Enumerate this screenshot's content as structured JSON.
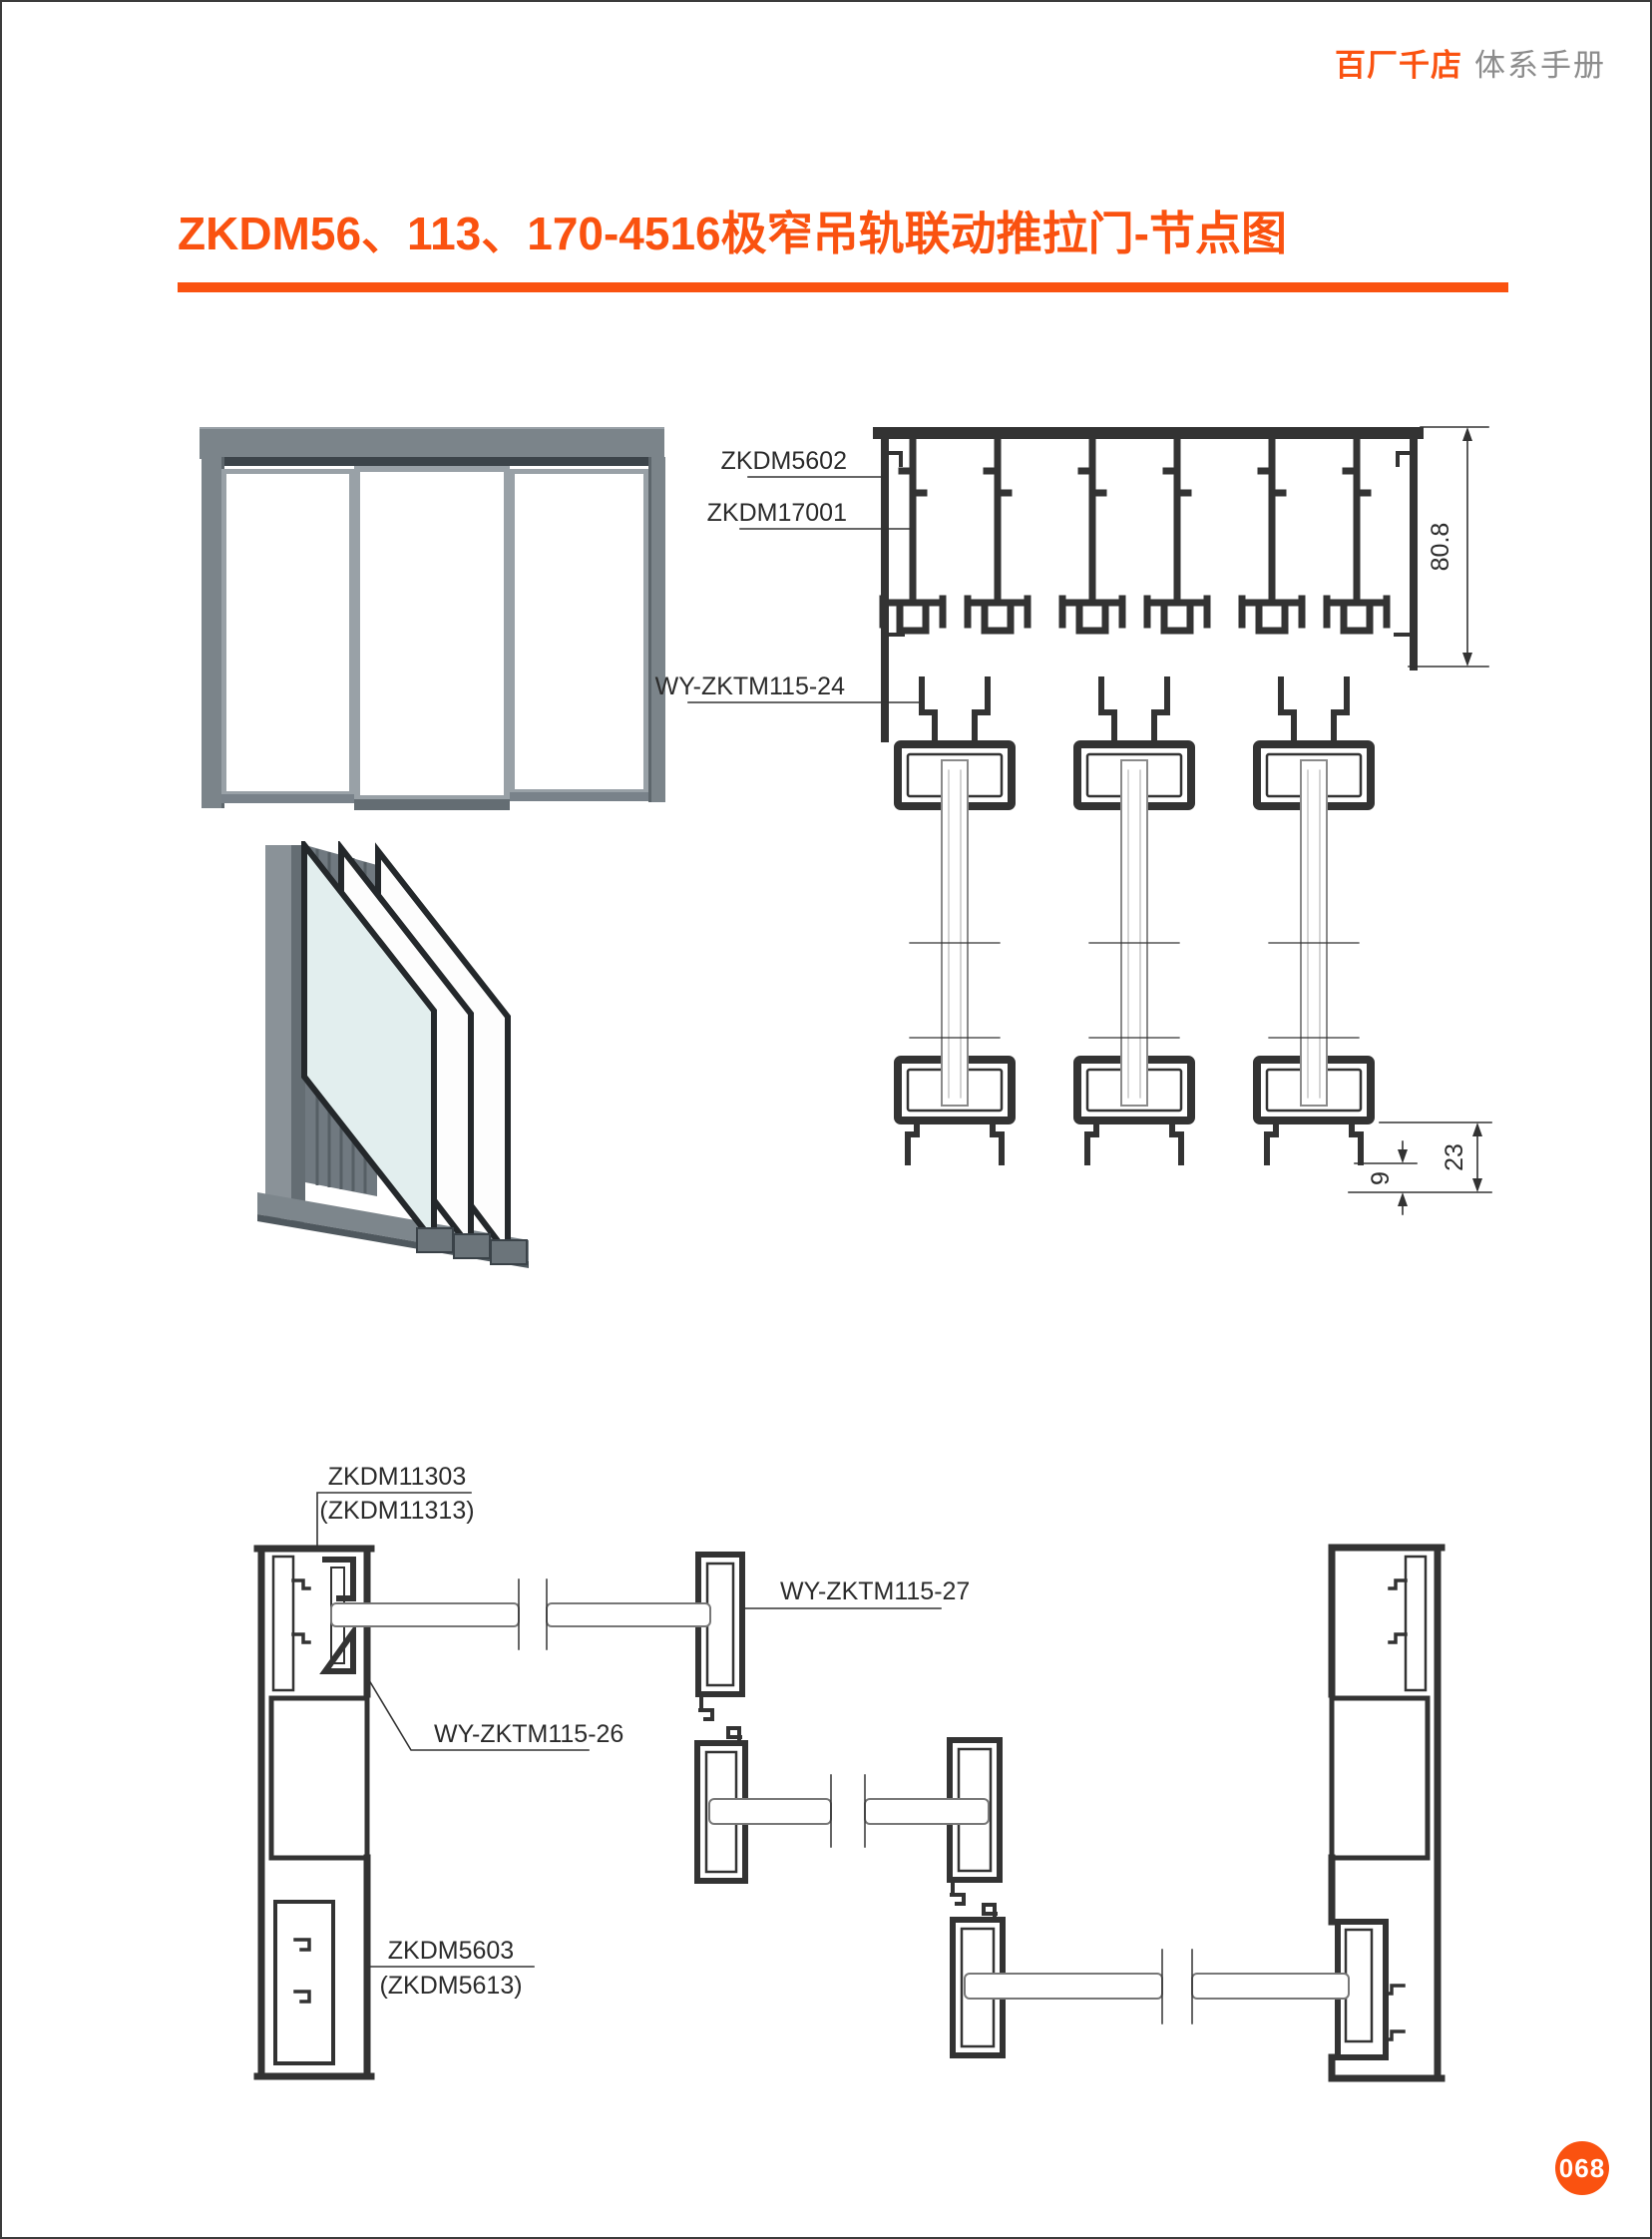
{
  "header": {
    "brand": "百厂千店",
    "manual_title": "体系手册"
  },
  "title": "ZKDM56、113、170-4516极窄吊轨联动推拉门-节点图",
  "footer": {
    "page_number": "068"
  },
  "colors": {
    "accent": "#fa5210",
    "header_gray": "#8c8c8c",
    "line": "#333333"
  },
  "top_drawing": {
    "labels": {
      "track_profile": "ZKDM5602",
      "inner_profile": "ZKDM17001",
      "hanger": "WY-ZKTM115-24"
    },
    "dimensions": {
      "track_height": "80.8",
      "floor_clearance": "23",
      "guide_gap": "9"
    }
  },
  "bottom_drawing": {
    "labels": {
      "jamb_top": "ZKDM11303",
      "jamb_top_alt": "(ZKDM11313)",
      "interlock": "WY-ZKTM115-27",
      "carrier": "WY-ZKTM115-26",
      "jamb_bottom": "ZKDM5603",
      "jamb_bottom_alt": "(ZKDM5613)"
    }
  }
}
